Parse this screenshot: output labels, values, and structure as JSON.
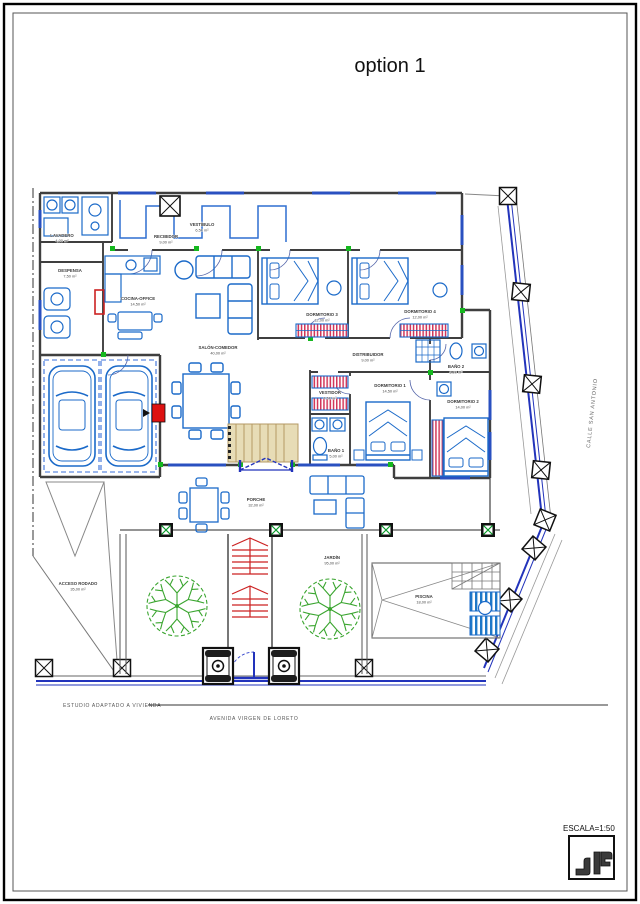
{
  "title": "option 1",
  "footer": {
    "left": "ESTUDIO ADAPTADO A VIVIENDA",
    "center": "AVENIDA VIRGEN DE LORETO"
  },
  "street_right": "CALLE SAN ANTONIO",
  "scale_label": "ESCALA=1:50",
  "colors": {
    "plan_blue": "#1b6ac9",
    "wall_gray": "#3f3f3f",
    "accent_red": "#cc2222",
    "tree_green": "#3aa52f",
    "boundary_blue": "#2233bb",
    "stair_beige": "#e7dcb6",
    "wardrobe_red": "#d2375a",
    "marker_green": "#15b81f"
  },
  "rooms": [
    {
      "name": "LAVADERO",
      "area": "4,00 m²"
    },
    {
      "name": "DESPENSA",
      "area": "7,50 m²"
    },
    {
      "name": "RECIBIDOR",
      "area": "9,00 m²"
    },
    {
      "name": "VESTÍBULO",
      "area": "6,50 m²"
    },
    {
      "name": "COCINA-OFFICE",
      "area": "14,50 m²"
    },
    {
      "name": "SALÓN-COMEDOR",
      "area": "40,00 m²"
    },
    {
      "name": "DORMITORIO 3",
      "area": "12,00 m²"
    },
    {
      "name": "DORMITORIO 4",
      "area": "12,00 m²"
    },
    {
      "name": "DISTRIBUIDOR",
      "area": "9,00 m²"
    },
    {
      "name": "BAÑO 2",
      "area": "5,00 m²"
    },
    {
      "name": "VESTIDOR",
      "area": "4,50 m²"
    },
    {
      "name": "DORMITORIO 1",
      "area": "14,50 m²"
    },
    {
      "name": "DORMITORIO 2",
      "area": "14,00 m²"
    },
    {
      "name": "BAÑO 1",
      "area": "5,00 m²"
    },
    {
      "name": "PORCHE",
      "area": "32,00 m²"
    },
    {
      "name": "JARDÍN",
      "area": "95,00 m²"
    },
    {
      "name": "PISCINA",
      "area": "18,00 m²"
    },
    {
      "name": "ACCESO RODADO",
      "area": "35,00 m²"
    }
  ]
}
